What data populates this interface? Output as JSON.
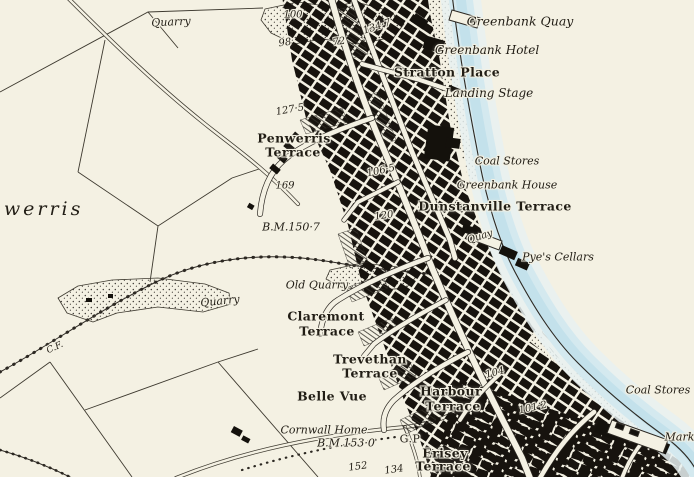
{
  "map": {
    "colors": {
      "paper": "#f4f1e3",
      "water_wash": "#cfe7ef",
      "water_edge": "#c3e1eb",
      "ink": "#2c2822",
      "building": "#14110c"
    },
    "labels": [
      {
        "id": "quarry-top",
        "text": "Quarry",
        "style": "italic",
        "x": 171,
        "y": 22,
        "rot": -3
      },
      {
        "id": "spot-100",
        "text": "100",
        "style": "number",
        "x": 293,
        "y": 15,
        "rot": 0
      },
      {
        "id": "spot-134-7",
        "text": "134·7",
        "style": "number",
        "x": 377,
        "y": 27,
        "rot": -18
      },
      {
        "id": "spot-98",
        "text": "98",
        "style": "number",
        "x": 285,
        "y": 43,
        "rot": -8
      },
      {
        "id": "spot-72",
        "text": "72",
        "style": "number",
        "x": 339,
        "y": 42,
        "rot": -8
      },
      {
        "id": "greenbank-quay",
        "text": "Greenbank Quay",
        "style": "italic",
        "x": 520,
        "y": 21,
        "size": 12.5
      },
      {
        "id": "greenbank-hotel",
        "text": "Greenbank Hotel",
        "style": "italic",
        "x": 487,
        "y": 50,
        "size": 12
      },
      {
        "id": "stratton-place",
        "text": "Stratton Place",
        "style": "bold",
        "x": 447,
        "y": 72
      },
      {
        "id": "landing-stage",
        "text": "Landing Stage",
        "style": "italic",
        "x": 489,
        "y": 93,
        "size": 12
      },
      {
        "id": "spot-127-5",
        "text": "127·5",
        "style": "number",
        "x": 290,
        "y": 110,
        "rot": -10
      },
      {
        "id": "penwerris-terrace-1",
        "text": "Penwerris",
        "style": "bold",
        "x": 294,
        "y": 138
      },
      {
        "id": "penwerris-terrace-2",
        "text": "Terrace",
        "style": "bold",
        "x": 293,
        "y": 152
      },
      {
        "id": "coal-stores-upper",
        "text": "Coal Stores",
        "style": "italic",
        "x": 507,
        "y": 161
      },
      {
        "id": "spot-106-5",
        "text": "106·5",
        "style": "number",
        "x": 381,
        "y": 171,
        "rot": -12
      },
      {
        "id": "spot-169",
        "text": "169",
        "style": "number",
        "x": 285,
        "y": 186
      },
      {
        "id": "greenbank-house",
        "text": "Greenbank House",
        "style": "italic",
        "x": 507,
        "y": 185
      },
      {
        "id": "dunstanville-terrace",
        "text": "Dunstanville Terrace",
        "style": "bold",
        "x": 495,
        "y": 206
      },
      {
        "id": "penwerris-district",
        "text": "nwerris",
        "style": "district",
        "x": 36,
        "y": 209
      },
      {
        "id": "bm-150-7",
        "text": "B.M.150·7",
        "style": "number",
        "x": 291,
        "y": 227,
        "size": 11
      },
      {
        "id": "spot-120",
        "text": "120",
        "style": "number",
        "x": 384,
        "y": 216,
        "rot": -8
      },
      {
        "id": "quay-mid",
        "text": "Quay",
        "style": "italic",
        "x": 480,
        "y": 237,
        "size": 10,
        "rot": -18
      },
      {
        "id": "pyes-cellars",
        "text": "Pye's Cellars",
        "style": "italic",
        "x": 558,
        "y": 257
      },
      {
        "id": "old-quarry",
        "text": "Old Quarry",
        "style": "italic",
        "x": 317,
        "y": 285
      },
      {
        "id": "quarry-left",
        "text": "Quarry",
        "style": "italic",
        "x": 220,
        "y": 301,
        "rot": -6
      },
      {
        "id": "claremont-terrace-1",
        "text": "Claremont",
        "style": "bold",
        "x": 326,
        "y": 316
      },
      {
        "id": "claremont-terrace-2",
        "text": "Terrace",
        "style": "bold",
        "x": 327,
        "y": 331
      },
      {
        "id": "cf-boundary",
        "text": "C.F.",
        "style": "small-italic",
        "x": 55,
        "y": 348,
        "rot": -25
      },
      {
        "id": "trevethan-terrace-1",
        "text": "Trevethan",
        "style": "bold",
        "x": 370,
        "y": 359
      },
      {
        "id": "trevethan-terrace-2",
        "text": "Terrace",
        "style": "bold",
        "x": 370,
        "y": 373
      },
      {
        "id": "spot-104",
        "text": "104",
        "style": "number",
        "x": 495,
        "y": 373,
        "rot": -15
      },
      {
        "id": "belle-vue",
        "text": "Belle Vue",
        "style": "bold",
        "x": 332,
        "y": 396
      },
      {
        "id": "harbour-terrace-1",
        "text": "Harbour",
        "style": "bold",
        "x": 451,
        "y": 391
      },
      {
        "id": "harbour-terrace-2",
        "text": "Terrace",
        "style": "bold",
        "x": 453,
        "y": 406
      },
      {
        "id": "coal-stores-lower",
        "text": "Coal Stores",
        "style": "italic",
        "x": 658,
        "y": 390
      },
      {
        "id": "spot-101-2",
        "text": "101·2",
        "style": "number",
        "x": 533,
        "y": 408,
        "rot": -12
      },
      {
        "id": "cornwall-home",
        "text": "Cornwall Home",
        "style": "italic",
        "x": 324,
        "y": 430
      },
      {
        "id": "bm-153-0",
        "text": "B.M.153·0",
        "style": "number",
        "x": 346,
        "y": 443,
        "size": 11
      },
      {
        "id": "gp-guide-post",
        "text": "G.P",
        "style": "plain",
        "x": 410,
        "y": 439
      },
      {
        "id": "market",
        "text": "Market",
        "style": "italic",
        "x": 685,
        "y": 437
      },
      {
        "id": "erisey-terrace-1",
        "text": "Erisey",
        "style": "bold",
        "x": 445,
        "y": 453
      },
      {
        "id": "erisey-terrace-2",
        "text": "Terrace",
        "style": "bold",
        "x": 443,
        "y": 466
      },
      {
        "id": "spot-152",
        "text": "152",
        "style": "number",
        "x": 358,
        "y": 467,
        "rot": -8
      },
      {
        "id": "spot-134",
        "text": "134",
        "style": "number",
        "x": 394,
        "y": 470,
        "rot": -8
      }
    ]
  }
}
